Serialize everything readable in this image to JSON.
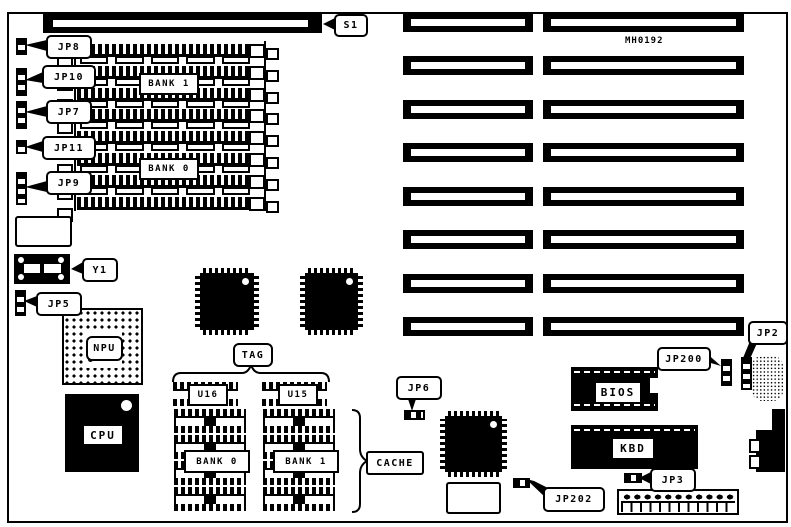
{
  "diagram": {
    "part_number": "MH0192",
    "callouts": {
      "s1": "S1",
      "jp8": "JP8",
      "jp10": "JP10",
      "jp7": "JP7",
      "jp11": "JP11",
      "jp9": "JP9",
      "y1": "Y1",
      "jp5": "JP5",
      "jp6": "JP6",
      "jp202": "JP202",
      "jp3": "JP3",
      "jp200": "JP200",
      "jp2": "JP2",
      "tag": "TAG",
      "cache": "CACHE"
    },
    "simm": {
      "bank1": "BANK 1",
      "bank0": "BANK 0"
    },
    "chips": {
      "npu": "NPU",
      "cpu": "CPU",
      "bios": "BIOS",
      "kbd": "KBD"
    },
    "cache_sockets": {
      "u16": "U16",
      "u15": "U15",
      "bank0": "BANK 0",
      "bank1": "BANK 1"
    },
    "colors": {
      "ink": "#000000",
      "paper": "#ffffff"
    }
  }
}
